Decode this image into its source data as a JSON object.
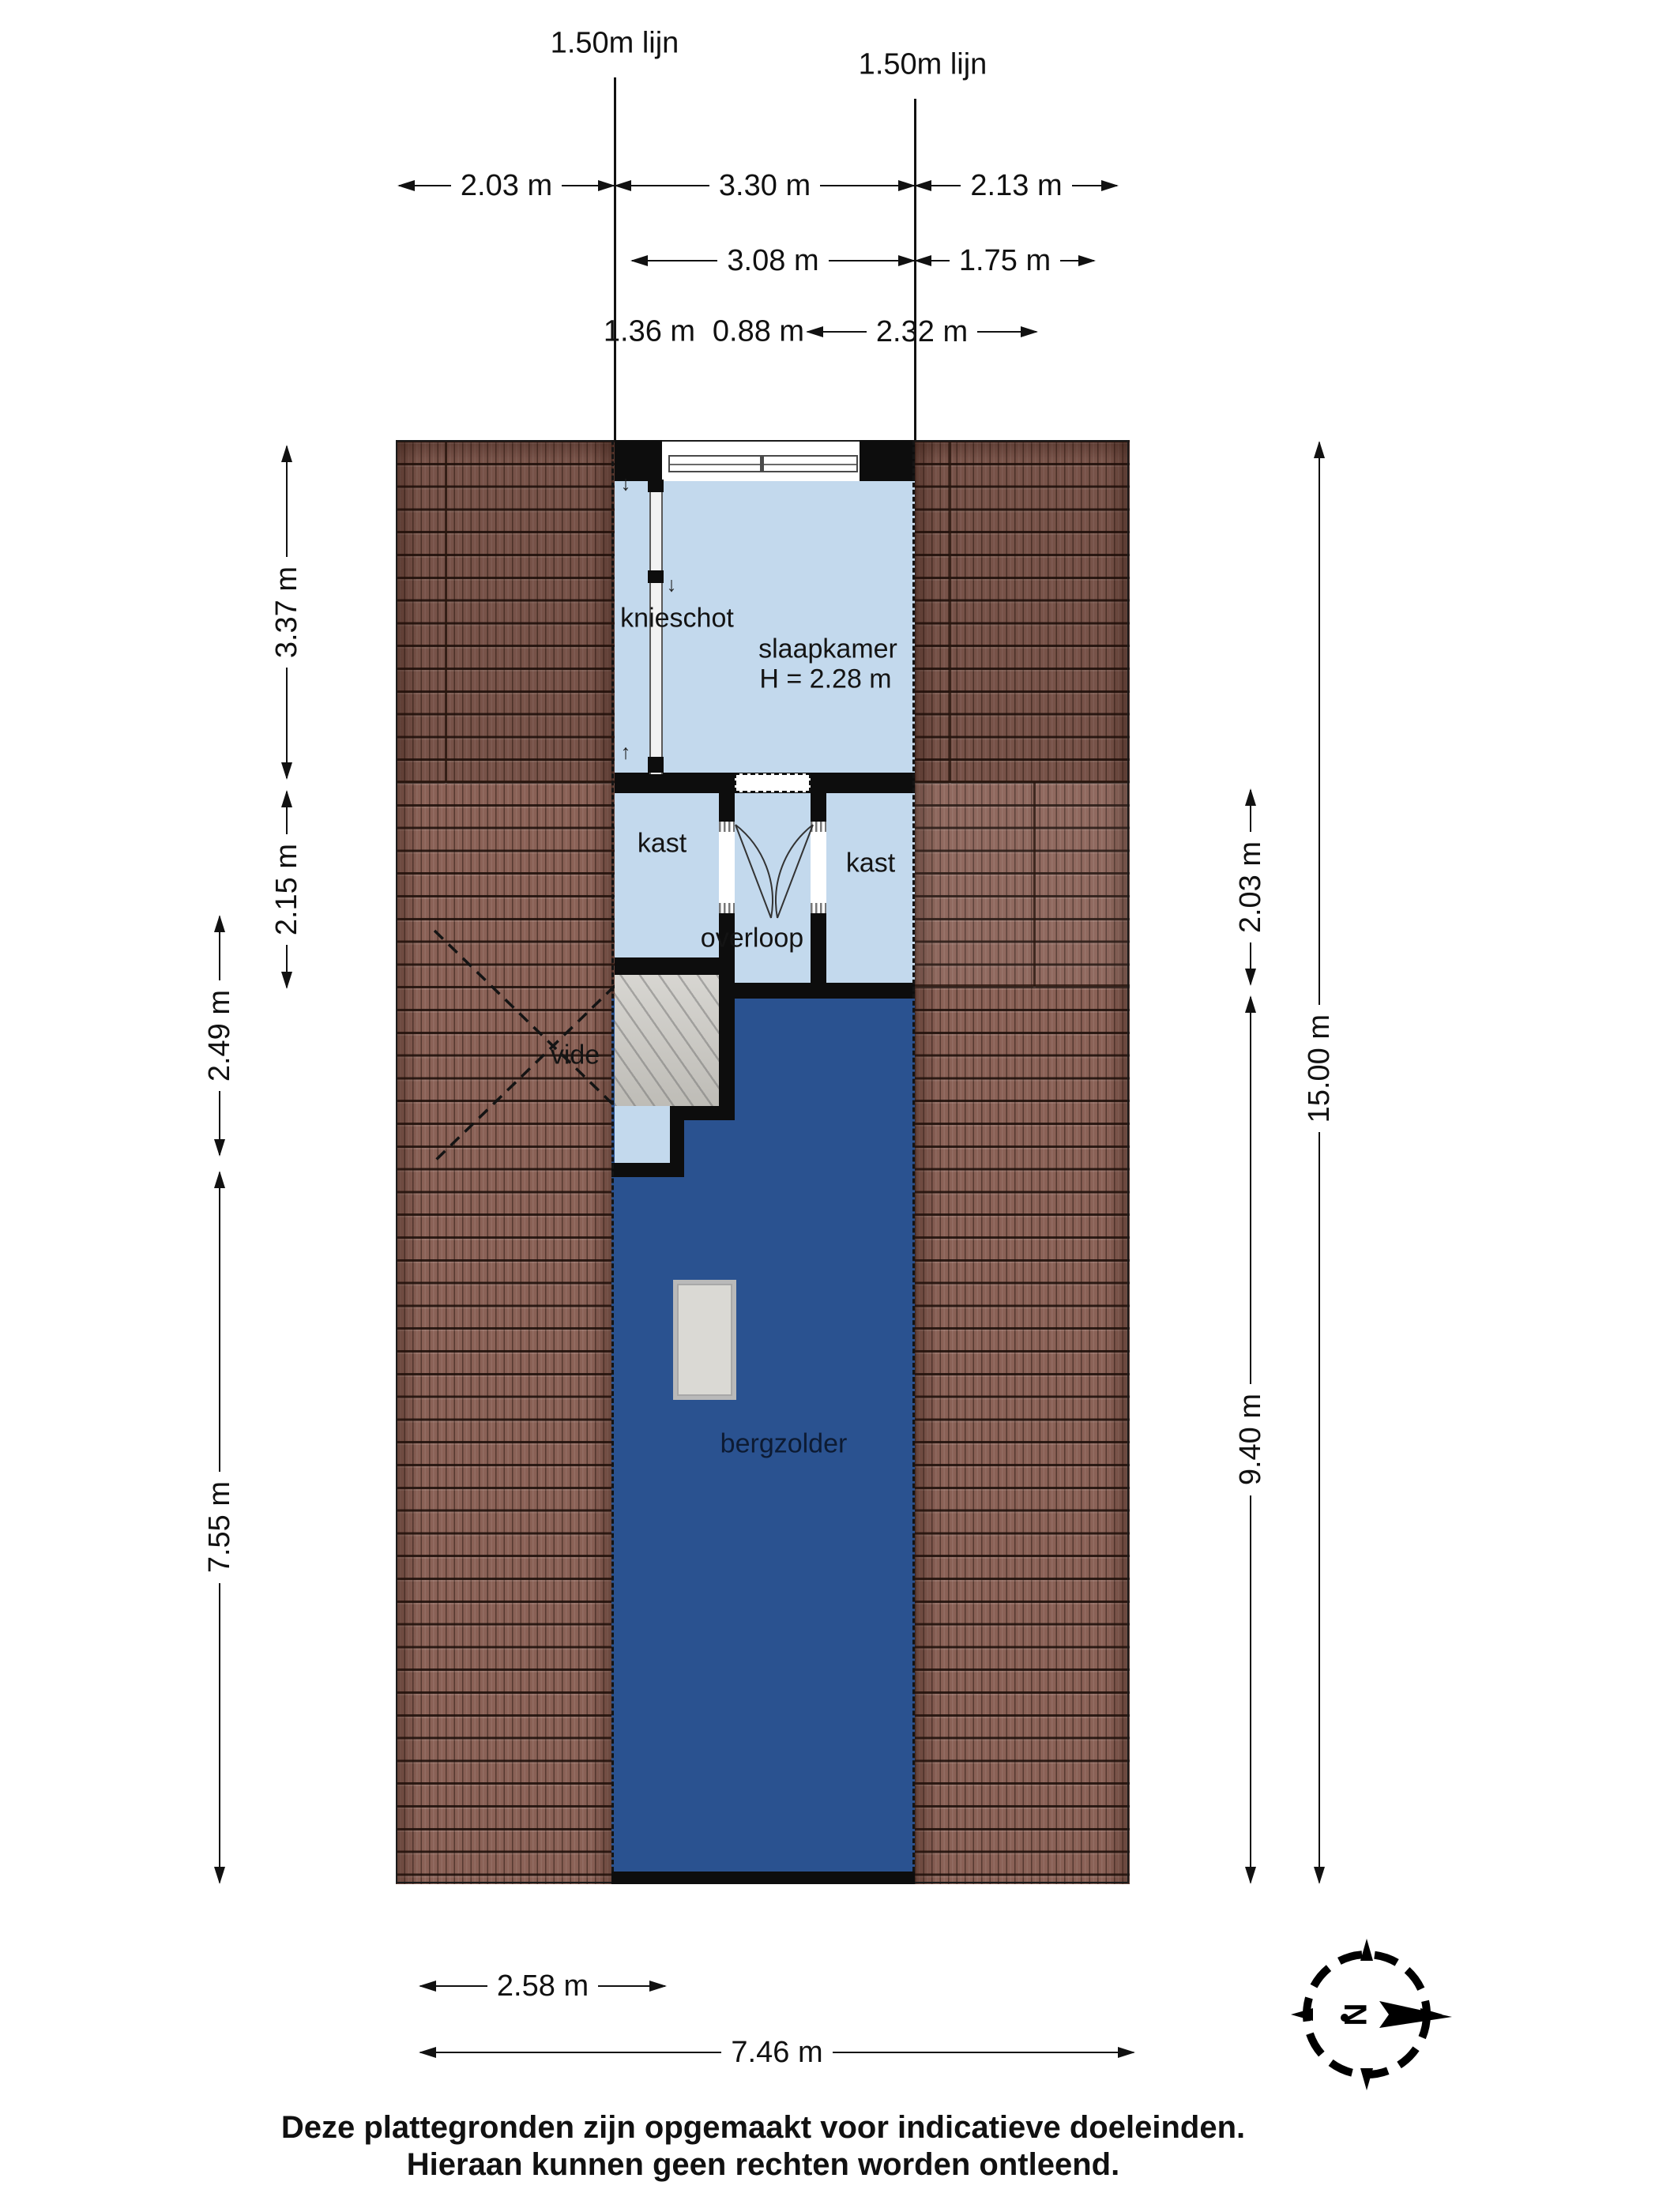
{
  "reference_lines": {
    "left": "1.50m lijn",
    "right": "1.50m lijn"
  },
  "dimensions": {
    "top_row1": [
      {
        "label": "2.03 m"
      },
      {
        "label": "3.30 m"
      },
      {
        "label": "2.13 m"
      }
    ],
    "top_row2": [
      {
        "label": "3.08 m"
      },
      {
        "label": "1.75 m"
      }
    ],
    "top_row3": [
      {
        "label": "1.36 m"
      },
      {
        "label": "0.88 m"
      },
      {
        "label": "2.32 m"
      }
    ],
    "left": [
      {
        "label": "3.37 m"
      },
      {
        "label": "2.15 m"
      },
      {
        "label": "2.49 m"
      },
      {
        "label": "7.55 m"
      }
    ],
    "right": [
      {
        "label": "2.03 m"
      },
      {
        "label": "9.40 m"
      },
      {
        "label": "15.00 m"
      }
    ],
    "bottom": [
      {
        "label": "2.58 m"
      },
      {
        "label": "7.46 m"
      }
    ]
  },
  "rooms": {
    "knieschot": "knieschot",
    "slaapkamer": "slaapkamer",
    "slaapkamer_height": "H = 2.28 m",
    "kast_left": "kast",
    "kast_right": "kast",
    "overloop": "overloop",
    "vide": "vide",
    "bergzolder": "bergzolder"
  },
  "compass": {
    "north_label": "N"
  },
  "footer": {
    "line1": "Deze plattegronden zijn opgemaakt voor indicatieve doeleinden.",
    "line2": "Hieraan kunnen geen rechten worden ontleend."
  },
  "colors": {
    "roof": "#8a6156",
    "floor_light": "#c3d9ed",
    "floor_dark": "#2a5290",
    "stairs": "#cac8c2",
    "wall": "#0d0d0d"
  }
}
